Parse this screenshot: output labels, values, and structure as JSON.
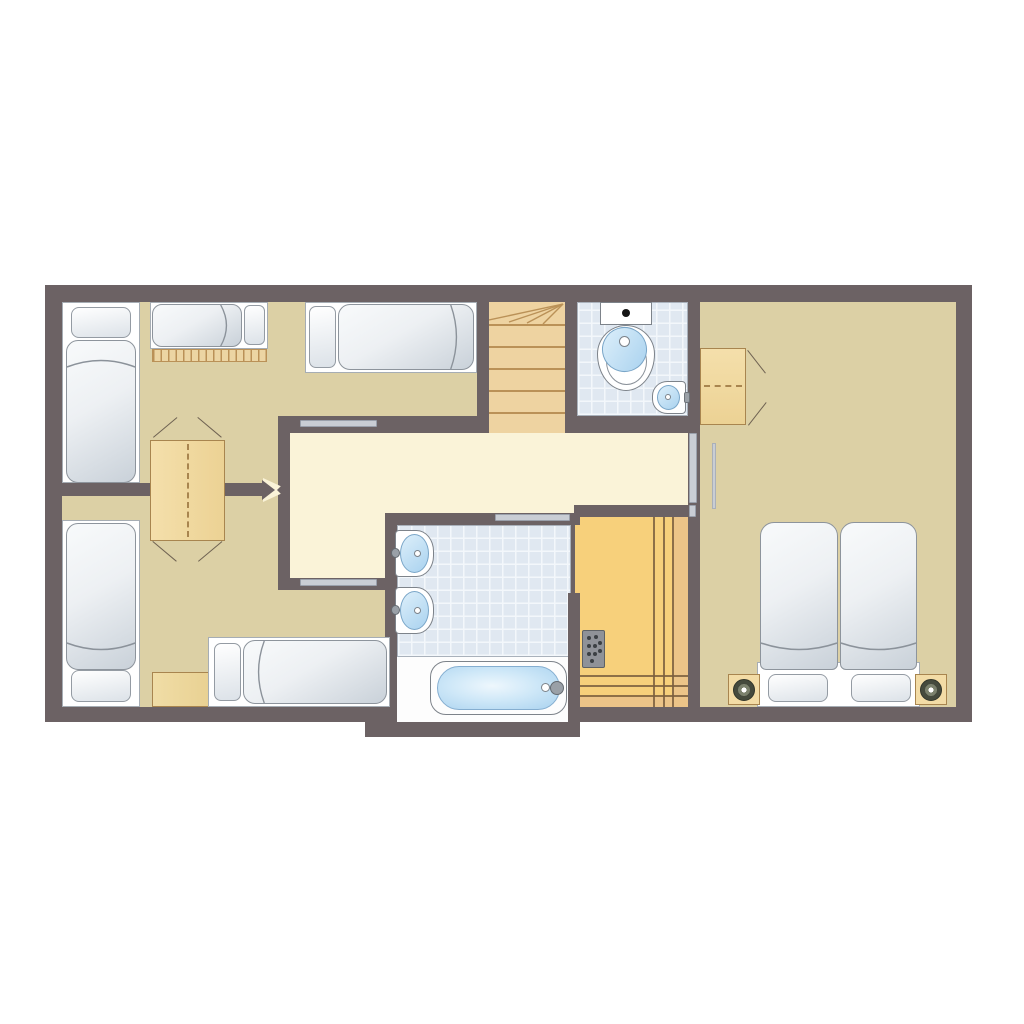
{
  "title": "holiday-home-floor-plan",
  "palette": {
    "background": "#ffffff",
    "wall": "#6c6264",
    "floor_bedroom": "#dcd0a5",
    "floor_hall": "#faf3d8",
    "floor_tile": "#e0e8f1",
    "tile_line": "#f3f7fb",
    "wood": "#f3dca6",
    "wood_line": "#a8854f",
    "stair_wood": "#eed3a1",
    "stair_line": "#ba9157",
    "sauna_floor": "#f7d07b",
    "sauna_bench": "#ecc488",
    "sauna_line": "#7b5f3e",
    "fixture_line": "#7d838a",
    "water": "#a9d2ef",
    "water_light": "#ddeffa",
    "door_bar": "#c9cdd4",
    "lamp_dark": "#454a3d",
    "lamp_mid": "#7b816d",
    "heater": "#8f9298",
    "heater_dot": "#3c4044"
  },
  "rooms": [
    {
      "id": "bedroom-top-left",
      "furniture": [
        "single-bed",
        "bunk-bed-with-ladder",
        "single-bed",
        "shared-double-wardrobe"
      ]
    },
    {
      "id": "bedroom-bottom-left",
      "furniture": [
        "single-bed",
        "single-bed",
        "nightstand",
        "shared-double-wardrobe"
      ]
    },
    {
      "id": "hallway",
      "furniture": []
    },
    {
      "id": "staircase",
      "furniture": [
        "winder-stairs"
      ]
    },
    {
      "id": "wc",
      "furniture": [
        "toilet",
        "corner-sink"
      ]
    },
    {
      "id": "bathroom",
      "furniture": [
        "sink",
        "sink",
        "bathtub"
      ]
    },
    {
      "id": "sauna",
      "furniture": [
        "heater",
        "bench-right",
        "bench-bottom"
      ]
    },
    {
      "id": "bedroom-right",
      "furniture": [
        "double-bed",
        "nightstand-left",
        "nightstand-right",
        "wardrobe"
      ]
    }
  ]
}
